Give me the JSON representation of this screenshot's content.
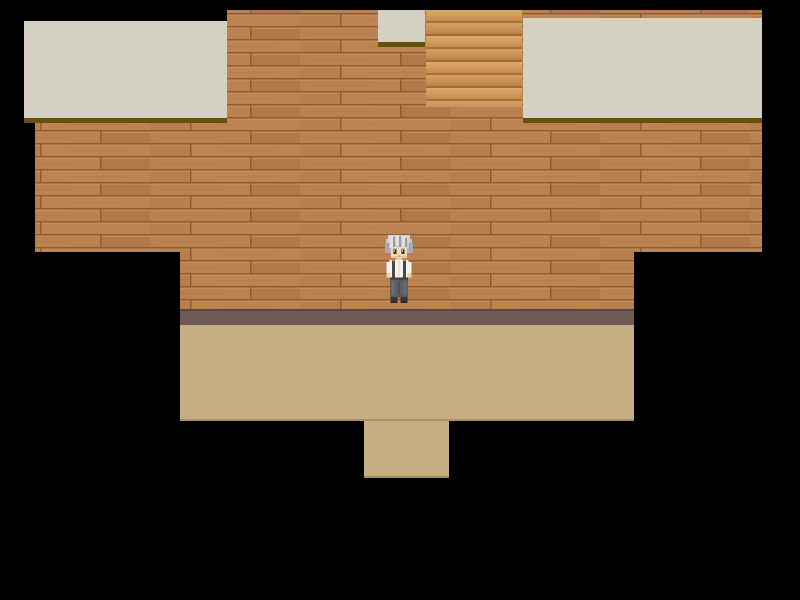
{
  "scene": {
    "description": "top-down RPG interior room with wooden plank wall, tan floor and black void",
    "background_color": "#000000",
    "palette": {
      "ceiling": "#d4d1c2",
      "ceiling_shadow": "#66500d",
      "wall_wood": "#b67d4c",
      "wall_seam": "#8f5c2d",
      "stairs_light": "#dda769",
      "stairs_mid": "#cd9254",
      "stairs_dark": "#a87034",
      "baseboard": "#6f5b53",
      "baseboard_edge": "#564741",
      "floor": "#c5ae83"
    },
    "wall_polygon": "227,10 762,10 762,252 634,252 634,309 180,309 180,252 35,252 35,123 227,123",
    "regions": {
      "ceiling_left": {
        "x": 24,
        "y": 21,
        "w": 203,
        "h": 97
      },
      "ceiling_right": {
        "x": 523,
        "y": 18,
        "w": 239,
        "h": 100
      },
      "ceiling_small": {
        "x": 378,
        "y": 10,
        "w": 47,
        "h": 32
      },
      "stairs": {
        "x": 426,
        "y": 10,
        "w": 96,
        "h": 97
      },
      "baseboard": {
        "x": 180,
        "y": 309,
        "w": 454,
        "h": 16
      },
      "floor": {
        "x": 180,
        "y": 325,
        "w": 454,
        "h": 96
      },
      "floor_tongue": {
        "x": 364,
        "y": 421,
        "w": 85,
        "h": 57
      },
      "character": {
        "x": 381,
        "y": 233,
        "w": 36,
        "h": 74
      }
    },
    "character": {
      "id": "gray-haired-man",
      "facing": "down",
      "colors": {
        "hair": "#c6c6cc",
        "hair_light": "#e0e0e4",
        "hair_dark": "#9b9ba4",
        "skin": "#f7d9b0",
        "shirt": "#f4f2ec",
        "suspenders": "#4c473f",
        "pants": "#5c5c63",
        "shoes": "#3a3633"
      }
    }
  }
}
